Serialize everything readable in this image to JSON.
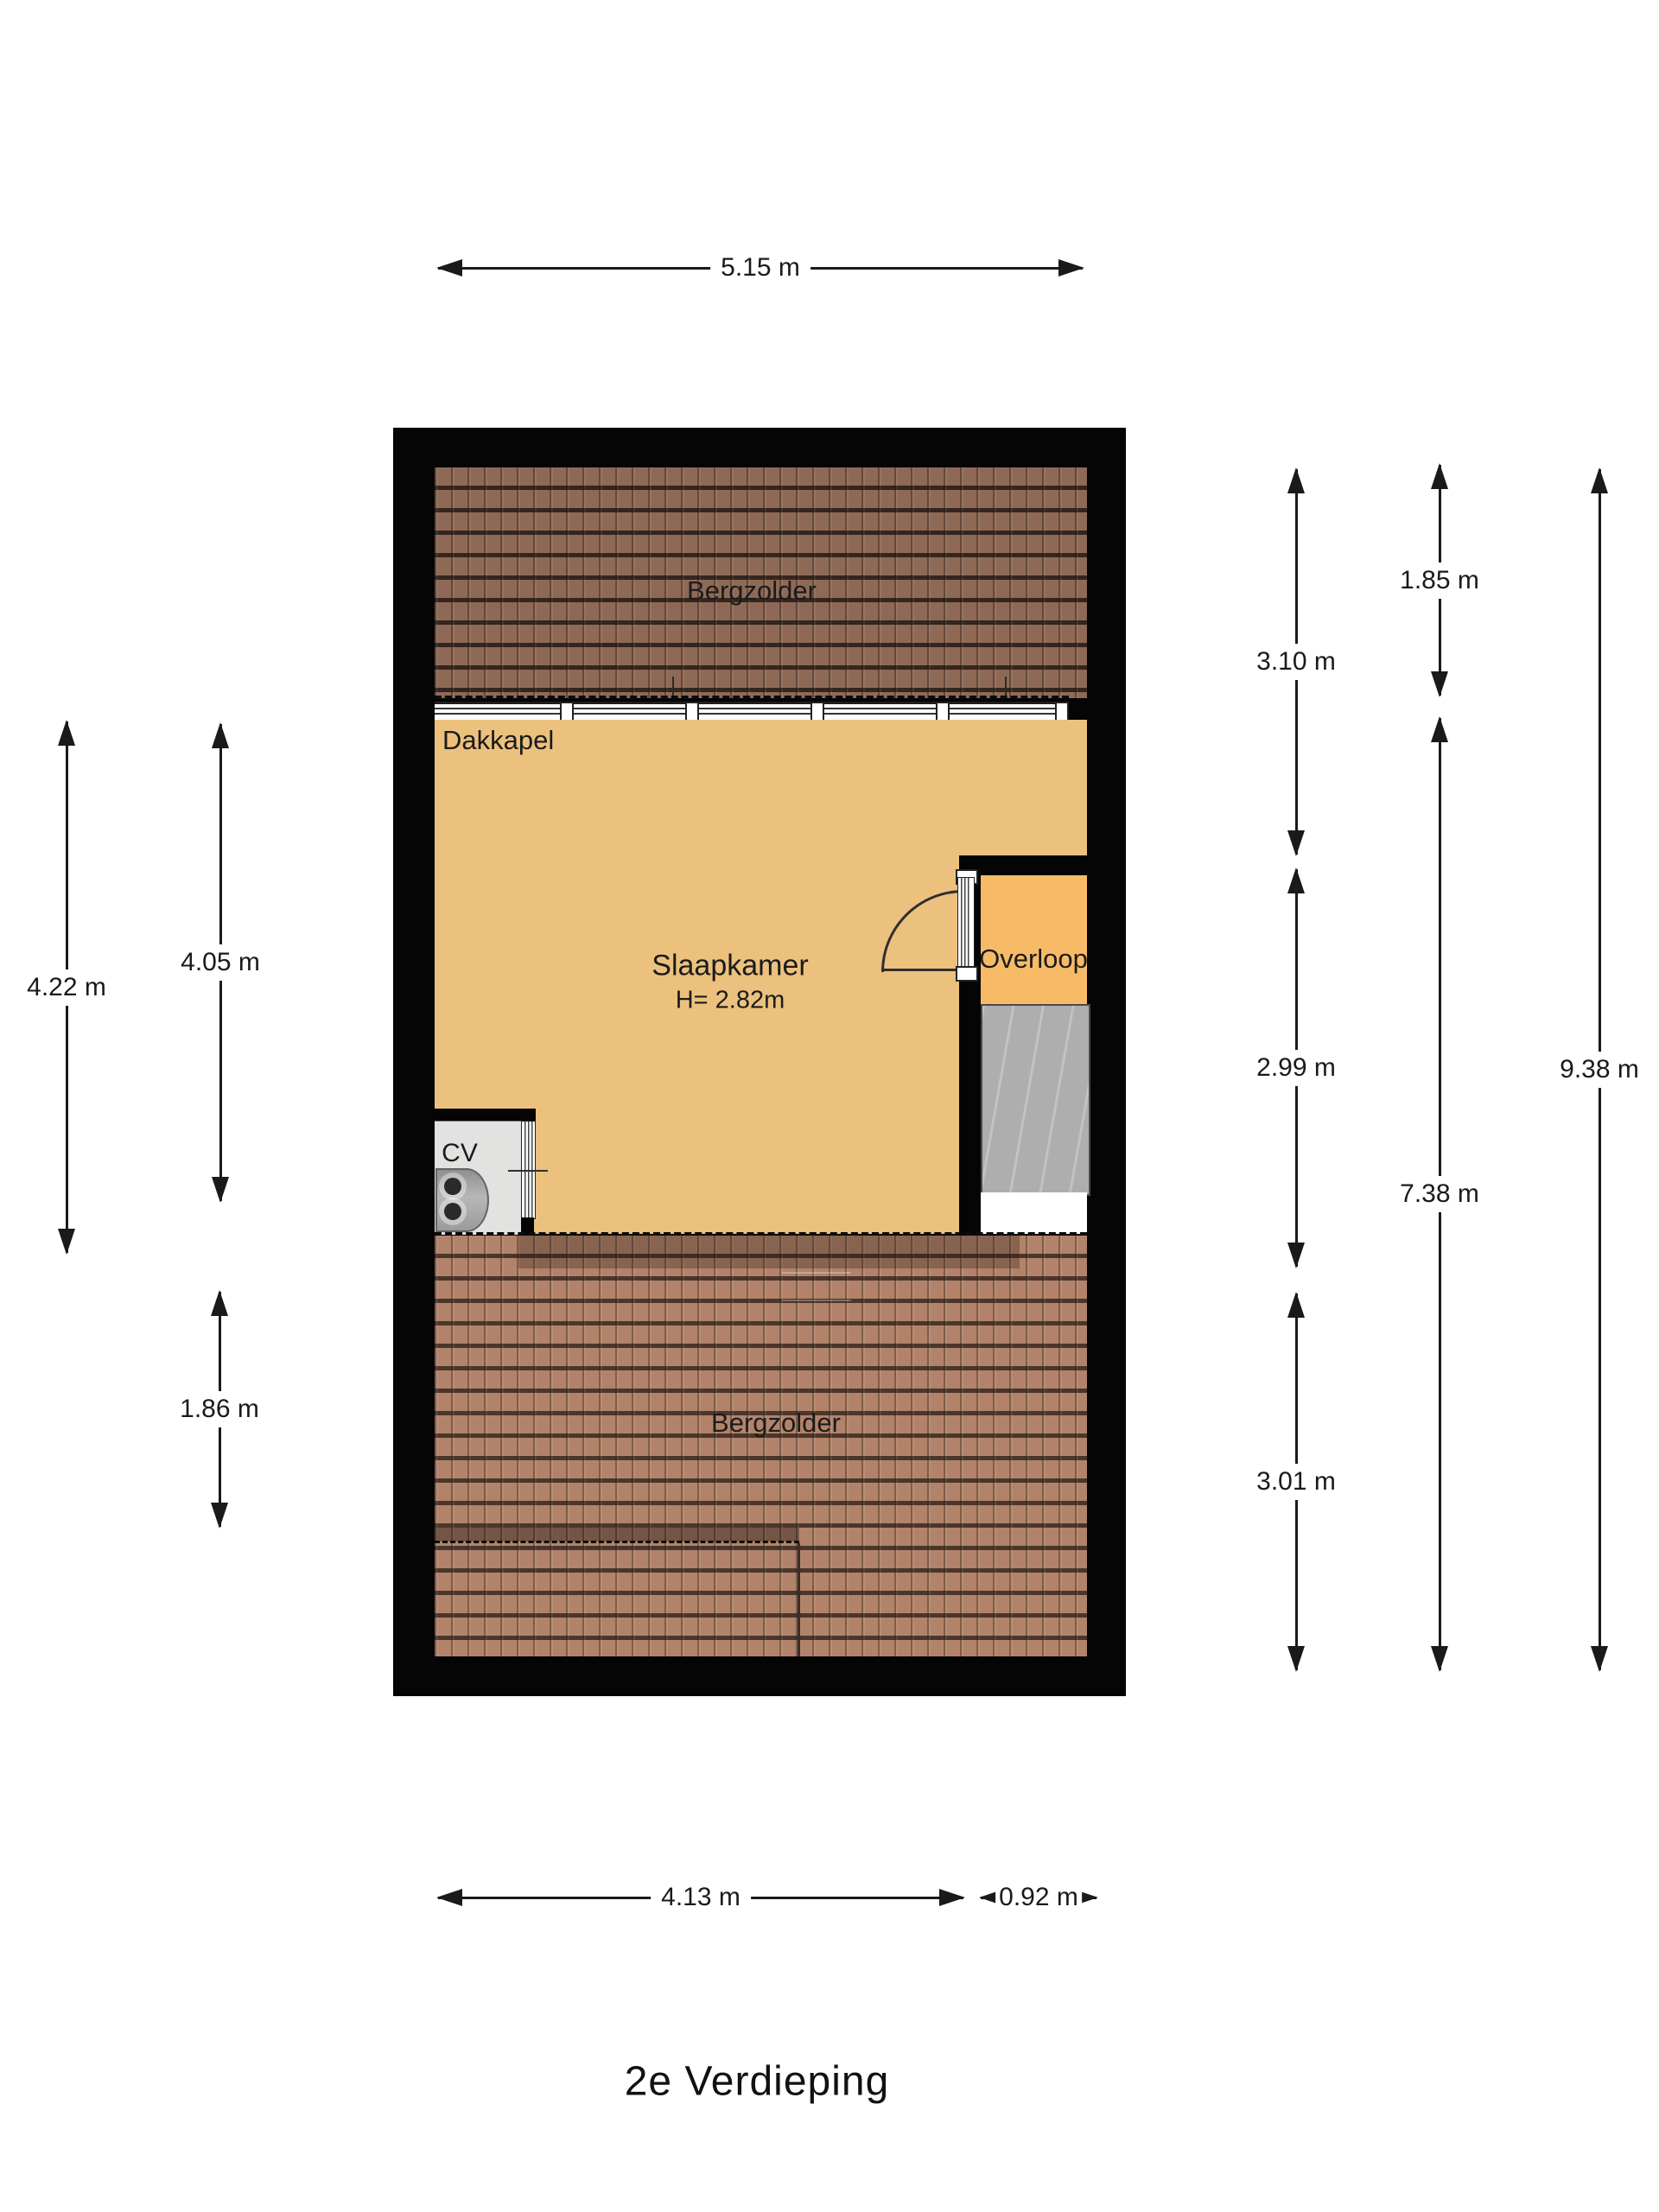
{
  "title": "2e Verdieping",
  "rooms": {
    "bergzolder_top": "Bergzolder",
    "bergzolder_bottom": "Bergzolder",
    "slaapkamer": "Slaapkamer",
    "slaapkamer_height": "H= 2.82m",
    "overloop": "Overloop",
    "dakkapel": "Dakkapel",
    "cv": "CV"
  },
  "dimensions": {
    "top_width": "5.15 m",
    "left_outer": "4.22 m",
    "left_inner": "4.05 m",
    "left_lower": "1.86 m",
    "right_top": "3.10 m",
    "right_middle": "2.99 m",
    "right_lower": "3.01 m",
    "right2_top": "1.85 m",
    "right2_bottom": "7.38 m",
    "right3_full": "9.38 m",
    "bottom_main": "4.13 m",
    "bottom_side": "0.92 m"
  },
  "colors": {
    "wall": "#050505",
    "slaapkamer_floor": "#ecc17e",
    "overloop_floor": "#f7bb68",
    "roof_top": "#8e6a56",
    "roof_bottom": "#b2836a",
    "stairs": "#aeaeae",
    "cv_floor": "#e2e2e0",
    "dimension": "#1a1a1a"
  }
}
